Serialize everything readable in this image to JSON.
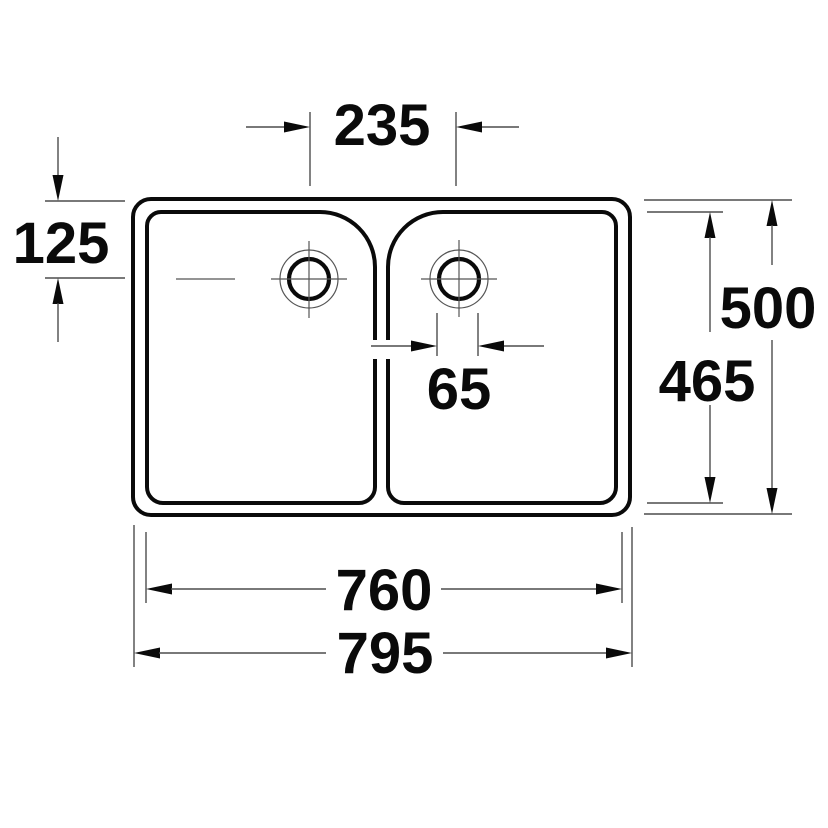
{
  "drawing": {
    "type": "technical-dimension-drawing",
    "subject": "double-bowl sink, top view",
    "unit": "mm",
    "background_color": "#ffffff",
    "line_color": "#0a0a0a",
    "thin_line_color": "#4d4d4d",
    "dimensions": {
      "drain_centers_spacing": "235",
      "drain_center_from_top": "125",
      "overall_depth": "500",
      "bowl_depth": "465",
      "drain_offset": "65",
      "bowls_span_width": "760",
      "overall_width": "795"
    }
  }
}
